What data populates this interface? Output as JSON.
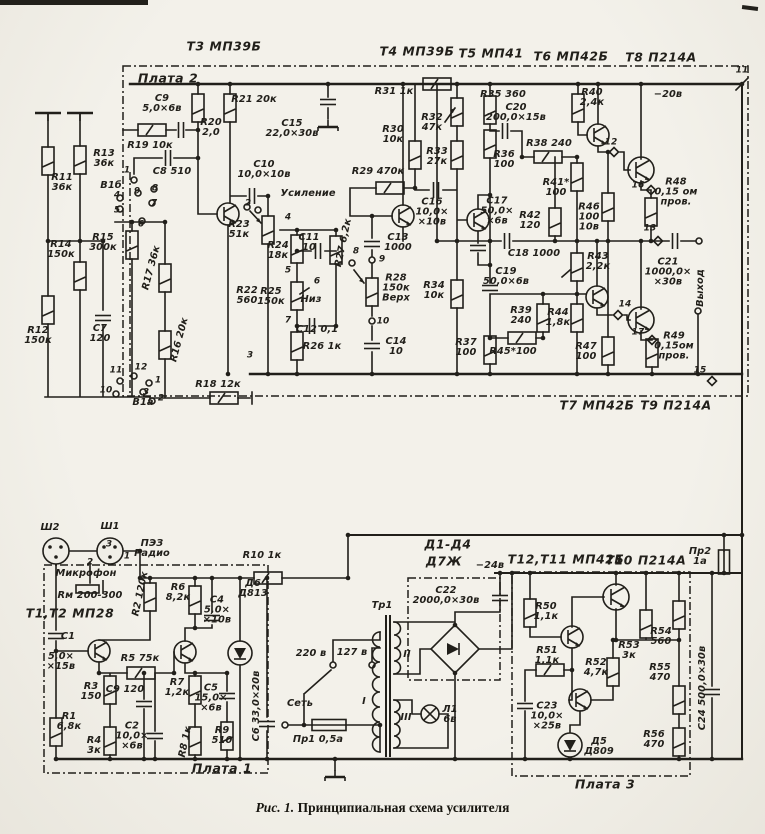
{
  "colors": {
    "ink": "#211f1a",
    "paper": "#f0eee7"
  },
  "caption": {
    "figure": "Рис. 1.",
    "title": "Принципиальная схема усилителя"
  },
  "labels": [
    {
      "t": "Т3 МП39Б",
      "x": 224,
      "y": 47,
      "c": "h",
      "n": "transistor-header-t3"
    },
    {
      "t": "Т4 МП39Б",
      "x": 417,
      "y": 52,
      "c": "h",
      "n": "transistor-header-t4"
    },
    {
      "t": "Т5 МП41",
      "x": 491,
      "y": 54,
      "c": "h",
      "n": "transistor-header-t5"
    },
    {
      "t": "Т6 МП42Б",
      "x": 571,
      "y": 57,
      "c": "h",
      "n": "transistor-header-t6"
    },
    {
      "t": "Т8 П214А",
      "x": 661,
      "y": 58,
      "c": "h",
      "n": "transistor-header-t8"
    },
    {
      "t": "Т7 МП42Б",
      "x": 597,
      "y": 406,
      "c": "h",
      "n": "transistor-header-t7"
    },
    {
      "t": "Т9 П214А",
      "x": 676,
      "y": 406,
      "c": "h",
      "n": "transistor-header-t9"
    },
    {
      "t": "Т12,Т11 МП42Б",
      "x": 566,
      "y": 560,
      "c": "h",
      "n": "transistor-header-t12-t11"
    },
    {
      "t": "Т10 П214А",
      "x": 646,
      "y": 561,
      "c": "h",
      "n": "transistor-header-t10"
    },
    {
      "t": "Т1,Т2 МП28",
      "x": 70,
      "y": 614,
      "c": "h",
      "n": "transistor-header-t1-t2"
    },
    {
      "t": "Д1-Д4",
      "x": 448,
      "y": 545,
      "c": "h",
      "n": "diode-header-d1-d4"
    },
    {
      "t": "Д7Ж",
      "x": 444,
      "y": 562,
      "c": "h",
      "n": "diode-header-type"
    },
    {
      "t": "Плата 2",
      "x": 168,
      "y": 78,
      "c": "b",
      "n": "board-label-2"
    },
    {
      "t": "Плата 1",
      "x": 222,
      "y": 768,
      "c": "b",
      "n": "board-label-1"
    },
    {
      "t": "Плата 3",
      "x": 605,
      "y": 784,
      "c": "b",
      "n": "board-label-3"
    },
    {
      "t": "−20в",
      "x": 668,
      "y": 95,
      "n": "supply-label-20v"
    },
    {
      "t": "−24в",
      "x": 490,
      "y": 566,
      "n": "supply-label-24v"
    },
    {
      "t": "Сеть",
      "x": 300,
      "y": 704,
      "n": "mains-label"
    },
    {
      "t": "Тр1",
      "x": 382,
      "y": 606,
      "n": "transformer-label"
    },
    {
      "t": "220 в",
      "x": 311,
      "y": 654,
      "n": "tap-220v"
    },
    {
      "t": "127 в",
      "x": 352,
      "y": 653,
      "n": "tap-127v"
    },
    {
      "t": "I",
      "x": 364,
      "y": 702,
      "n": "winding-1"
    },
    {
      "t": "II",
      "x": 407,
      "y": 655,
      "n": "winding-2"
    },
    {
      "t": "III",
      "x": 406,
      "y": 718,
      "n": "winding-3"
    },
    {
      "t": "Л1\n6в",
      "x": 450,
      "y": 715,
      "n": "lamp-label"
    },
    {
      "t": "Пр1 0,5а",
      "x": 318,
      "y": 740,
      "n": "fuse-1-label"
    },
    {
      "t": "Пр2\n1а",
      "x": 700,
      "y": 557,
      "n": "fuse-2-label"
    },
    {
      "t": "Усиление",
      "x": 308,
      "y": 194,
      "n": "volume-control-label"
    },
    {
      "t": "Низ",
      "x": 311,
      "y": 300,
      "n": "bass-control-label"
    },
    {
      "t": "Выход",
      "x": 701,
      "y": 288,
      "r": -90,
      "n": "output-label"
    },
    {
      "t": "Микрофон",
      "x": 86,
      "y": 574,
      "n": "microphone-label"
    },
    {
      "t": "Rм 200-300",
      "x": 90,
      "y": 596,
      "n": "microphone-impedance"
    },
    {
      "t": "ПЭЗ\nРадио",
      "x": 152,
      "y": 549,
      "n": "radio-input-label"
    },
    {
      "t": "Ш2",
      "x": 50,
      "y": 528,
      "n": "connector-sh2"
    },
    {
      "t": "Ш1",
      "x": 110,
      "y": 527,
      "n": "connector-sh1"
    },
    {
      "t": "В1б",
      "x": 111,
      "y": 186,
      "n": "switch-v1b"
    },
    {
      "t": "В1а",
      "x": 143,
      "y": 403,
      "n": "switch-v1a"
    },
    {
      "t": "11",
      "x": 742,
      "y": 71,
      "c": "p"
    },
    {
      "t": "12",
      "x": 611,
      "y": 143,
      "c": "p"
    },
    {
      "t": "16",
      "x": 638,
      "y": 186,
      "c": "p"
    },
    {
      "t": "13",
      "x": 650,
      "y": 229,
      "c": "p"
    },
    {
      "t": "14",
      "x": 625,
      "y": 305,
      "c": "p"
    },
    {
      "t": "17",
      "x": 638,
      "y": 333,
      "c": "p"
    },
    {
      "t": "15",
      "x": 700,
      "y": 371,
      "c": "p"
    },
    {
      "t": "1",
      "x": 127,
      "y": 171,
      "c": "p"
    },
    {
      "t": "4",
      "x": 117,
      "y": 196,
      "c": "p"
    },
    {
      "t": "9",
      "x": 137,
      "y": 192,
      "c": "p"
    },
    {
      "t": "8",
      "x": 155,
      "y": 189,
      "c": "p"
    },
    {
      "t": "5",
      "x": 117,
      "y": 211,
      "c": "p"
    },
    {
      "t": "7",
      "x": 154,
      "y": 204,
      "c": "p"
    },
    {
      "t": "6",
      "x": 141,
      "y": 225,
      "c": "p"
    },
    {
      "t": "11",
      "x": 116,
      "y": 371,
      "c": "p"
    },
    {
      "t": "12",
      "x": 141,
      "y": 368,
      "c": "p"
    },
    {
      "t": "10",
      "x": 106,
      "y": 391,
      "c": "p"
    },
    {
      "t": "1",
      "x": 158,
      "y": 381,
      "c": "p"
    },
    {
      "t": "3",
      "x": 146,
      "y": 393,
      "c": "p"
    },
    {
      "t": "2",
      "x": 161,
      "y": 399,
      "c": "p"
    },
    {
      "t": "2",
      "x": 248,
      "y": 204,
      "c": "p"
    },
    {
      "t": "4",
      "x": 288,
      "y": 218,
      "c": "p"
    },
    {
      "t": "8",
      "x": 356,
      "y": 252,
      "c": "p"
    },
    {
      "t": "5",
      "x": 288,
      "y": 271,
      "c": "p"
    },
    {
      "t": "6",
      "x": 317,
      "y": 282,
      "c": "p"
    },
    {
      "t": "7",
      "x": 288,
      "y": 321,
      "c": "p"
    },
    {
      "t": "9",
      "x": 382,
      "y": 260,
      "c": "p"
    },
    {
      "t": "10",
      "x": 383,
      "y": 322,
      "c": "p"
    },
    {
      "t": "3",
      "x": 250,
      "y": 356,
      "c": "p"
    },
    {
      "t": "3",
      "x": 109,
      "y": 545,
      "c": "p"
    },
    {
      "t": "2",
      "x": 90,
      "y": 563,
      "c": "p"
    },
    {
      "t": "1",
      "x": 127,
      "y": 557,
      "c": "p"
    },
    {
      "t": "R13\n36к",
      "x": 104,
      "y": 159
    },
    {
      "t": "R11\n36к",
      "x": 62,
      "y": 183
    },
    {
      "t": "С9\n5,0×6в",
      "x": 162,
      "y": 104
    },
    {
      "t": "R19 10к",
      "x": 150,
      "y": 146
    },
    {
      "t": "С8 510",
      "x": 172,
      "y": 172
    },
    {
      "t": "R20\n2,0",
      "x": 211,
      "y": 128
    },
    {
      "t": "R21 20к",
      "x": 254,
      "y": 100
    },
    {
      "t": "R15\n300к",
      "x": 103,
      "y": 243
    },
    {
      "t": "R14\n150к",
      "x": 61,
      "y": 250
    },
    {
      "t": "R17 36к",
      "x": 152,
      "y": 268,
      "r": -75
    },
    {
      "t": "R16 20к",
      "x": 180,
      "y": 340,
      "r": -75
    },
    {
      "t": "R12\n150к",
      "x": 38,
      "y": 336
    },
    {
      "t": "С7\n120",
      "x": 100,
      "y": 334
    },
    {
      "t": "R18 12к",
      "x": 218,
      "y": 385
    },
    {
      "t": "R22\n560",
      "x": 247,
      "y": 296
    },
    {
      "t": "С15\n22,0×30в",
      "x": 292,
      "y": 129
    },
    {
      "t": "С10\n10,0×10в",
      "x": 264,
      "y": 170
    },
    {
      "t": "R23\n51к",
      "x": 239,
      "y": 230
    },
    {
      "t": "R24\n18к",
      "x": 278,
      "y": 251
    },
    {
      "t": "С11\n10",
      "x": 309,
      "y": 243
    },
    {
      "t": "R27 6,2к",
      "x": 344,
      "y": 243,
      "r": -78
    },
    {
      "t": "R25\n150к",
      "x": 271,
      "y": 297
    },
    {
      "t": "С12 0,1",
      "x": 317,
      "y": 330
    },
    {
      "t": "R26 1к",
      "x": 322,
      "y": 347
    },
    {
      "t": "С13\n1000",
      "x": 398,
      "y": 243
    },
    {
      "t": "R28\n150к\nВерх",
      "x": 396,
      "y": 289
    },
    {
      "t": "С14\n10",
      "x": 396,
      "y": 347
    },
    {
      "t": "R31 1к",
      "x": 394,
      "y": 92
    },
    {
      "t": "R30\n10к",
      "x": 393,
      "y": 135
    },
    {
      "t": "R32\n47к",
      "x": 432,
      "y": 123
    },
    {
      "t": "R33\n27к",
      "x": 437,
      "y": 157
    },
    {
      "t": "R29 470к",
      "x": 378,
      "y": 172
    },
    {
      "t": "С16\n10,0×\n×10в",
      "x": 432,
      "y": 213
    },
    {
      "t": "R34\n10к",
      "x": 434,
      "y": 291
    },
    {
      "t": "R35 360",
      "x": 503,
      "y": 95
    },
    {
      "t": "С20\n200,0×15в",
      "x": 516,
      "y": 113
    },
    {
      "t": "R36\n100",
      "x": 504,
      "y": 160
    },
    {
      "t": "R38 240",
      "x": 549,
      "y": 144
    },
    {
      "t": "R41*\n100",
      "x": 556,
      "y": 188
    },
    {
      "t": "R40\n2,4к",
      "x": 592,
      "y": 98
    },
    {
      "t": "R42\n120",
      "x": 530,
      "y": 221
    },
    {
      "t": "С17\n50,0×\n×6в",
      "x": 497,
      "y": 212
    },
    {
      "t": "R46\n100\n10в",
      "x": 589,
      "y": 218
    },
    {
      "t": "R48\n0,15 ом\nпров.",
      "x": 676,
      "y": 193
    },
    {
      "t": "С21\n1000,0×\n×30в",
      "x": 668,
      "y": 273
    },
    {
      "t": "С18 1000",
      "x": 534,
      "y": 254
    },
    {
      "t": "С19\n50,0×6в",
      "x": 506,
      "y": 277
    },
    {
      "t": "R43\n2,2к",
      "x": 598,
      "y": 262
    },
    {
      "t": "R39\n240",
      "x": 521,
      "y": 316
    },
    {
      "t": "R44\n1,8к",
      "x": 558,
      "y": 318
    },
    {
      "t": "R45*100",
      "x": 513,
      "y": 352
    },
    {
      "t": "R37\n100",
      "x": 466,
      "y": 348
    },
    {
      "t": "R47\n100",
      "x": 586,
      "y": 352
    },
    {
      "t": "R49\n0,15ом\nпров.",
      "x": 674,
      "y": 347
    },
    {
      "t": "R10 1к",
      "x": 262,
      "y": 556
    },
    {
      "t": "Д6\nД813",
      "x": 253,
      "y": 589
    },
    {
      "t": "R2 120к",
      "x": 141,
      "y": 594,
      "r": -78
    },
    {
      "t": "R6\n8,2к",
      "x": 178,
      "y": 593
    },
    {
      "t": "С4\n5,0×\n×10в",
      "x": 217,
      "y": 611
    },
    {
      "t": "С1",
      "x": 68,
      "y": 637
    },
    {
      "t": "5,0×\n×15в",
      "x": 61,
      "y": 662
    },
    {
      "t": "R5 75к",
      "x": 140,
      "y": 659
    },
    {
      "t": "С9 120",
      "x": 125,
      "y": 690
    },
    {
      "t": "R7\n1,2к",
      "x": 177,
      "y": 688
    },
    {
      "t": "R3\n150",
      "x": 91,
      "y": 692
    },
    {
      "t": "R1\n6,8к",
      "x": 69,
      "y": 722
    },
    {
      "t": "R4\n3к",
      "x": 94,
      "y": 746
    },
    {
      "t": "С2\n10,0×\n×6в",
      "x": 132,
      "y": 737
    },
    {
      "t": "С5\n15,0×\n×6в",
      "x": 211,
      "y": 699
    },
    {
      "t": "R9\n510",
      "x": 222,
      "y": 736
    },
    {
      "t": "R8 1к",
      "x": 186,
      "y": 742,
      "r": -78
    },
    {
      "t": "С6 33,0×20в",
      "x": 257,
      "y": 706,
      "r": -90
    },
    {
      "t": "С22\n2000,0×30в",
      "x": 446,
      "y": 596
    },
    {
      "t": "R50\n1,1к",
      "x": 546,
      "y": 612
    },
    {
      "t": "R51\n1,1к",
      "x": 547,
      "y": 656
    },
    {
      "t": "R52\n4,7к",
      "x": 596,
      "y": 668
    },
    {
      "t": "R53\n3к",
      "x": 629,
      "y": 651
    },
    {
      "t": "R54\n560",
      "x": 661,
      "y": 637
    },
    {
      "t": "R55\n470",
      "x": 660,
      "y": 673
    },
    {
      "t": "С23\n10,0×\n×25в",
      "x": 547,
      "y": 717
    },
    {
      "t": "Д5\nД809",
      "x": 599,
      "y": 747
    },
    {
      "t": "R56\n470",
      "x": 654,
      "y": 740
    },
    {
      "t": "С24 500,0×30в",
      "x": 703,
      "y": 688,
      "r": -90
    }
  ]
}
